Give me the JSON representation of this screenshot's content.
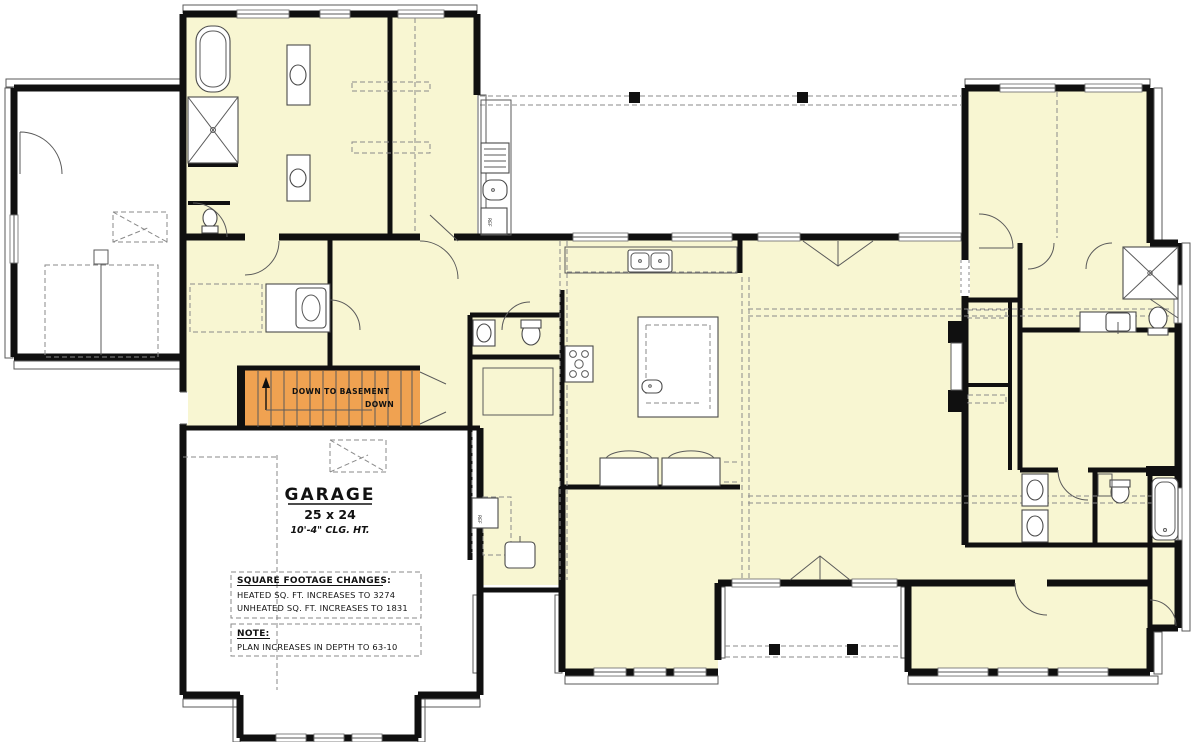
{
  "plan": {
    "type": "floor-plan",
    "colors": {
      "heated_area": "#F8F6D2",
      "unheated_area": "#FFFFFF",
      "stair_highlight": "#F0A251",
      "walls": "#101010"
    },
    "rooms": {
      "garage": {
        "name": "GARAGE",
        "dimensions": "25 x 24",
        "ceiling": "10'-4\" CLG. HT."
      }
    },
    "stairs": {
      "label": "DOWN TO BASEMENT",
      "direction": "DOWN"
    },
    "notes": {
      "sqft": {
        "heading": "SQUARE FOOTAGE CHANGES:",
        "line1": "HEATED SQ. FT. INCREASES TO 3274",
        "line2": "UNHEATED SQ. FT. INCREASES TO 1831"
      },
      "general": {
        "heading": "NOTE:",
        "line1": "PLAN INCREASES IN DEPTH TO 63-10"
      }
    },
    "appliances": {
      "ref": "REF"
    }
  }
}
